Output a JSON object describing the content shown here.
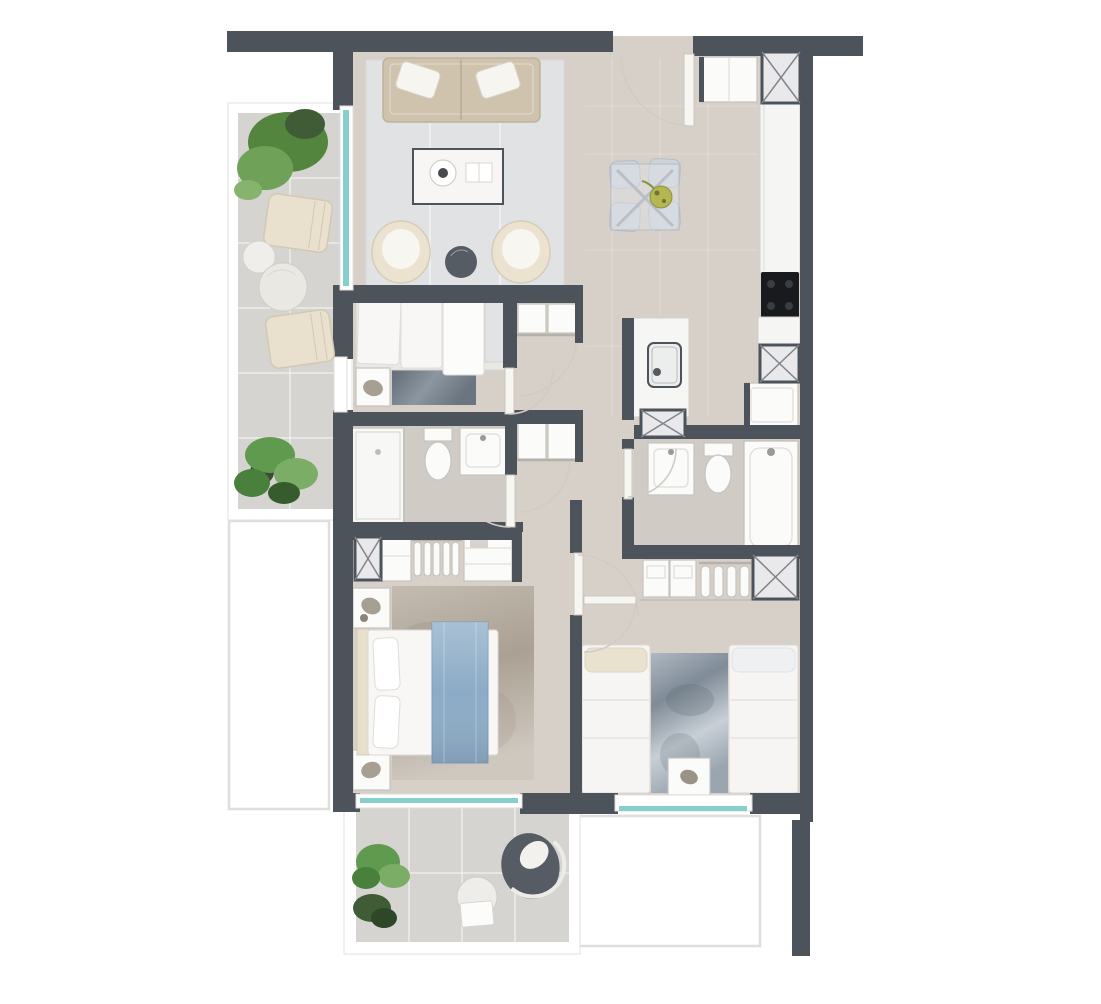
{
  "meta": {
    "title": "Apartment floor plan — top-down 2D architectural render",
    "view": "plan view, no text labels or dimensions shown"
  },
  "colors": {
    "background": "#ffffff",
    "wall": "#4d535a",
    "floor": "#d7d0c8",
    "floor_bathroom": "#d0ccc5",
    "floor_balcony": "#d5d4d1",
    "rug_living": "#e1e2e4",
    "rug_cool_base": "#9aa5b0",
    "rug_dark_base": "#67727d",
    "rug_warm_base": "#b9b1a7",
    "furniture_white": "#fbfbfa",
    "furniture_beige": "#e9e1cd",
    "sofa": "#cfc3ae",
    "bed_blue": "#8cabc6",
    "glass": "#86cfcd",
    "plant": "#5f9a4e",
    "plant_dark": "#3f5c36",
    "plant_centerpiece": "#b4b652",
    "cooktop": "#191a1d",
    "chair_gray": "#ccd4db",
    "dark_accent": "#565c63",
    "shaft_fill": "#e9e9eb",
    "shaft_line": "#80858c",
    "neighbor_outline": "#dededb"
  },
  "rooms": [
    {
      "id": "balcony-west",
      "name": "West balcony",
      "contents": [
        "large potted plant",
        "lounge chair",
        "small round side table",
        "large round side table",
        "second lounge chair",
        "potted monstera plant"
      ]
    },
    {
      "id": "living-room",
      "name": "Living room",
      "contents": [
        "three-seat sofa with two pillows",
        "light area rug",
        "coffee table with round tray and book",
        "barrel armchair left",
        "dark round side table",
        "barrel armchair right",
        "sliding glass door to balcony"
      ]
    },
    {
      "id": "dining-area",
      "name": "Dining area",
      "contents": [
        "cross-base dining table",
        "four upholstered chairs",
        "plant centerpiece"
      ]
    },
    {
      "id": "entry",
      "name": "Entry",
      "contents": [
        "entrance door with swing arc",
        "entry closet"
      ]
    },
    {
      "id": "kitchen",
      "name": "Kitchen",
      "contents": [
        "counter run along east wall",
        "black cooktop",
        "island counter with sink",
        "service shaft",
        "appliance / refrigerator"
      ]
    },
    {
      "id": "bedroom-1",
      "name": "Bedroom 1",
      "contents": [
        "bed against north wall",
        "nightstand with decor",
        "dark rug",
        "window to balcony"
      ]
    },
    {
      "id": "bathroom-1",
      "name": "Bathroom 1",
      "contents": [
        "walk-in shower",
        "toilet",
        "washbasin cabinet"
      ]
    },
    {
      "id": "hallway",
      "name": "Hallway",
      "contents": [
        "built-in wardrobe upper",
        "built-in wardrobe lower",
        "door swing arcs"
      ]
    },
    {
      "id": "bathroom-2",
      "name": "Bathroom 2",
      "contents": [
        "washbasin cabinet",
        "toilet",
        "bathtub"
      ]
    },
    {
      "id": "laundry-nook",
      "name": "Laundry nook",
      "contents": [
        "washing machine",
        "service shaft"
      ]
    },
    {
      "id": "master-bedroom",
      "name": "Master bedroom",
      "contents": [
        "double bed with blue runner",
        "two nightstands with lamps",
        "warm area rug",
        "closet with shaft, shelves and hanging rail",
        "window to south balcony"
      ]
    },
    {
      "id": "bedroom-2",
      "name": "Bedroom 2",
      "contents": [
        "twin bed left",
        "twin bed right",
        "mottled runner rug",
        "shared nightstand",
        "closet with cubbies, hanging rail and shaft",
        "south window"
      ]
    },
    {
      "id": "balcony-south",
      "name": "South balcony",
      "contents": [
        "green potted plant",
        "dark potted plant",
        "round table with box",
        "egg lounge chair"
      ]
    },
    {
      "id": "neighbor-left",
      "name": "Adjacent unit outline left",
      "contents": []
    },
    {
      "id": "neighbor-bottom-right",
      "name": "Adjacent unit outline bottom right",
      "contents": []
    }
  ],
  "symbols": {
    "x_square": "service / duct shaft",
    "quarter_arc": "door swing",
    "teal_line": "window / glass door",
    "white_outline": "adjacent structure"
  }
}
